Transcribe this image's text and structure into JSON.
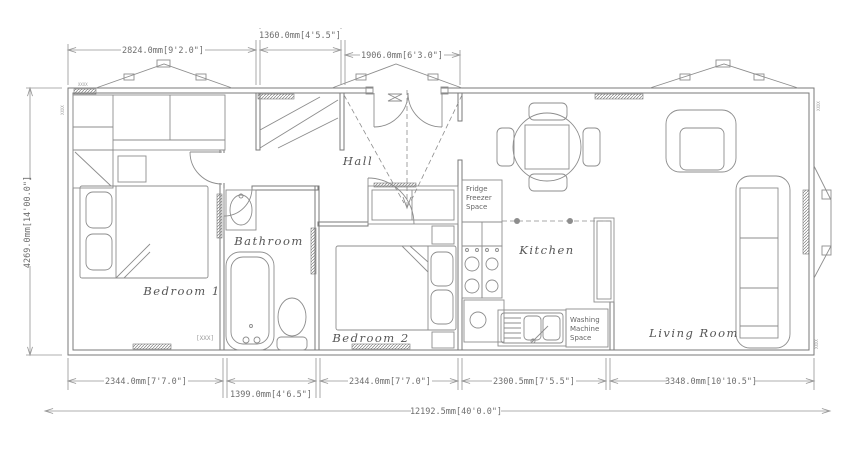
{
  "rooms": {
    "hall": "Hall",
    "bathroom": "Bathroom",
    "bedroom1": "Bedroom 1",
    "bedroom2": "Bedroom 2",
    "kitchen": "Kitchen",
    "living_room": "Living Room"
  },
  "fixtures": {
    "fridge": [
      "Fridge",
      "Freezer",
      "Space"
    ],
    "washing": [
      "Washing",
      "Machine",
      "Space"
    ]
  },
  "dimensions": {
    "top": [
      "2824.0mm[9'2.0\"]",
      "1360.0mm[4'5.5\"]",
      "1906.0mm[6'3.0\"]"
    ],
    "left": "4269.0mm[14'00.0\"]",
    "bottom": [
      "2344.0mm[7'7.0\"]",
      "1399.0mm[4'6.5\"]",
      "2344.0mm[7'7.0\"]",
      "2300.5mm[7'5.5\"]",
      "3348.0mm[10'10.5\"]"
    ],
    "overall": "12192.5mm[40'0.0\"]"
  },
  "annotations": {
    "window_tag": "[XXX]",
    "corner_tag": "XXXX"
  },
  "colors": {
    "line": "#8d8d8d",
    "wall": "#7a7a7a",
    "dim_text": "#6e6e6e",
    "label_text": "#555555",
    "background": "#ffffff"
  }
}
